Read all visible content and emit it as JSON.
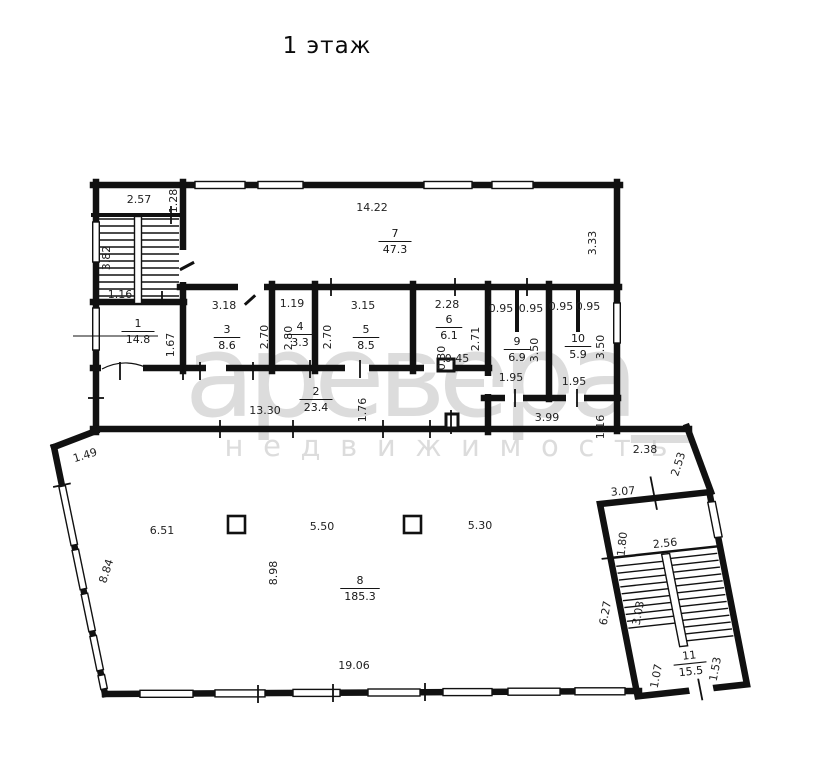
{
  "title": "1 этаж",
  "watermark": {
    "line1": "аревера_",
    "line2": "н е д в и ж и м о с т ь"
  },
  "rooms": [
    {
      "num": "1",
      "area": "14.8",
      "x": 138,
      "y": 331
    },
    {
      "num": "2",
      "area": "23.4",
      "x": 316,
      "y": 399
    },
    {
      "num": "3",
      "area": "8.6",
      "x": 227,
      "y": 337
    },
    {
      "num": "4",
      "area": "3.3",
      "x": 300,
      "y": 334
    },
    {
      "num": "5",
      "area": "8.5",
      "x": 366,
      "y": 337
    },
    {
      "num": "6",
      "area": "6.1",
      "x": 449,
      "y": 327
    },
    {
      "num": "7",
      "area": "47.3",
      "x": 395,
      "y": 241
    },
    {
      "num": "8",
      "area": "185.3",
      "x": 360,
      "y": 588
    },
    {
      "num": "9",
      "area": "6.9",
      "x": 517,
      "y": 349
    },
    {
      "num": "10",
      "area": "5.9",
      "x": 578,
      "y": 346
    },
    {
      "num": "11",
      "area": "15.5",
      "x": 690,
      "y": 663,
      "rot": -6
    }
  ],
  "dimensions": [
    {
      "text": "2.57",
      "x": 139,
      "y": 199
    },
    {
      "text": "1.28",
      "x": 173,
      "y": 201,
      "rot": -90
    },
    {
      "text": "3.82",
      "x": 106,
      "y": 258,
      "rot": -90
    },
    {
      "text": "1.16",
      "x": 120,
      "y": 294
    },
    {
      "text": "1.67",
      "x": 170,
      "y": 345,
      "rot": -90
    },
    {
      "text": "14.22",
      "x": 372,
      "y": 207
    },
    {
      "text": "3.33",
      "x": 592,
      "y": 243,
      "rot": -90
    },
    {
      "text": "3.18",
      "x": 224,
      "y": 305
    },
    {
      "text": "2.70",
      "x": 264,
      "y": 337,
      "rot": -90
    },
    {
      "text": "1.19",
      "x": 292,
      "y": 303
    },
    {
      "text": "2.80",
      "x": 288,
      "y": 338,
      "rot": -90
    },
    {
      "text": "3.15",
      "x": 363,
      "y": 305
    },
    {
      "text": "2.70",
      "x": 327,
      "y": 337,
      "rot": -90
    },
    {
      "text": "2.28",
      "x": 447,
      "y": 304
    },
    {
      "text": "2.71",
      "x": 475,
      "y": 339,
      "rot": -90
    },
    {
      "text": "0.45",
      "x": 457,
      "y": 358,
      "size": 9.5
    },
    {
      "text": "0.30",
      "x": 441,
      "y": 358,
      "rot": -90,
      "size": 9
    },
    {
      "text": "0.95",
      "x": 501,
      "y": 308
    },
    {
      "text": "0.95",
      "x": 531,
      "y": 308
    },
    {
      "text": "0.95",
      "x": 561,
      "y": 306
    },
    {
      "text": "0.95",
      "x": 588,
      "y": 306
    },
    {
      "text": "3.50",
      "x": 534,
      "y": 350,
      "rot": -90
    },
    {
      "text": "3.50",
      "x": 600,
      "y": 347,
      "rot": -90
    },
    {
      "text": "1.95",
      "x": 511,
      "y": 377
    },
    {
      "text": "1.95",
      "x": 574,
      "y": 381
    },
    {
      "text": "13.30",
      "x": 265,
      "y": 410
    },
    {
      "text": "1.76",
      "x": 362,
      "y": 410,
      "rot": -90
    },
    {
      "text": "3.99",
      "x": 547,
      "y": 417
    },
    {
      "text": "1.16",
      "x": 600,
      "y": 427,
      "rot": -90
    },
    {
      "text": "2.38",
      "x": 645,
      "y": 449
    },
    {
      "text": "2.53",
      "x": 678,
      "y": 464,
      "rot": -72
    },
    {
      "text": "3.07",
      "x": 623,
      "y": 491,
      "rot": -4
    },
    {
      "text": "1.80",
      "x": 622,
      "y": 544,
      "rot": -84
    },
    {
      "text": "2.56",
      "x": 665,
      "y": 543,
      "rot": -6
    },
    {
      "text": "6.27",
      "x": 605,
      "y": 613,
      "rot": -79
    },
    {
      "text": "3.03",
      "x": 638,
      "y": 613,
      "rot": -79
    },
    {
      "text": "1.07",
      "x": 656,
      "y": 676,
      "rot": -79
    },
    {
      "text": "1.53",
      "x": 715,
      "y": 669,
      "rot": -79
    },
    {
      "text": "1.49",
      "x": 85,
      "y": 455,
      "rot": -17
    },
    {
      "text": "6.51",
      "x": 162,
      "y": 530
    },
    {
      "text": "5.50",
      "x": 322,
      "y": 526
    },
    {
      "text": "5.30",
      "x": 480,
      "y": 525
    },
    {
      "text": "8.84",
      "x": 106,
      "y": 571,
      "rot": -72
    },
    {
      "text": "8.98",
      "x": 273,
      "y": 573,
      "rot": -90
    },
    {
      "text": "19.06",
      "x": 354,
      "y": 665
    }
  ]
}
